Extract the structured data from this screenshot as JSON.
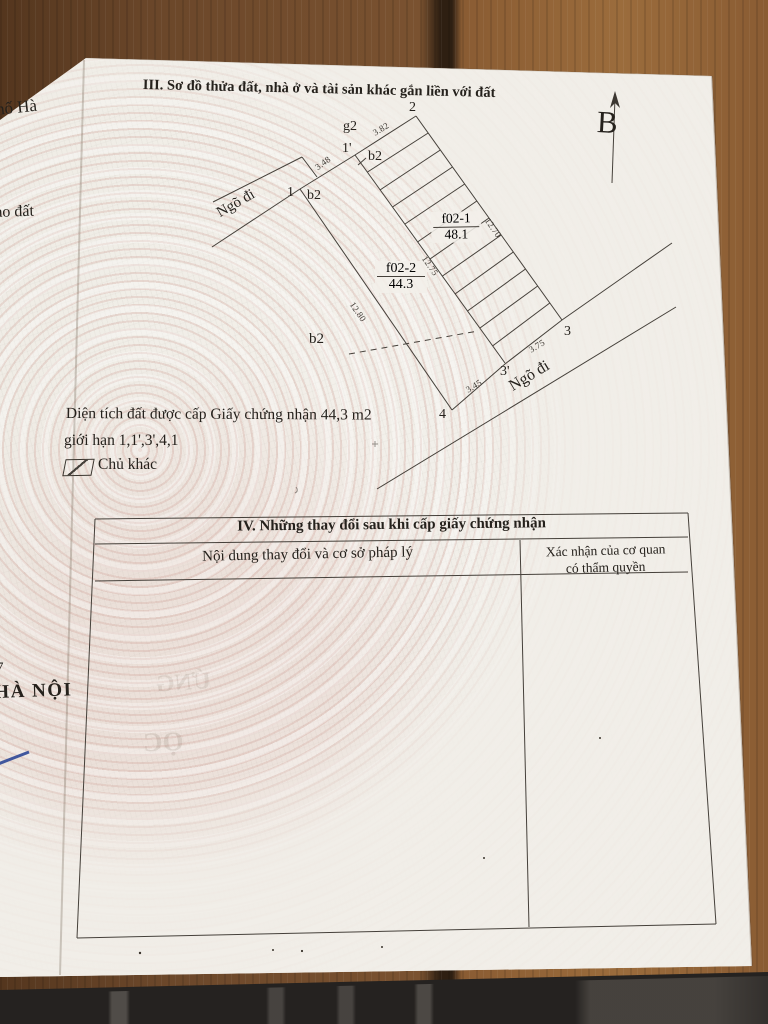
{
  "page": {
    "section3_title": "III. Sơ đồ thửa đất, nhà ở và tài sản khác gắn liền với đất",
    "north_label": "B",
    "notes": {
      "area_line1": "Diện tích đất được cấp Giấy chứng nhận 44,3 m2",
      "area_line2": "giới hạn 1,1',3',4,1"
    },
    "legend": {
      "other_owner": "Chủ khác"
    },
    "section4": {
      "title": "IV. Những thay đổi sau khi cấp giấy chứng nhận",
      "col1": "Nội dung thay đổi và cơ sở pháp lý",
      "col2_line1": "Xác nhận của cơ quan",
      "col2_line2": "có thẩm quyền"
    }
  },
  "diagram": {
    "vertices": {
      "v1": "1",
      "v1p": "1'",
      "v2": "2",
      "v3": "3",
      "v3p": "3'",
      "v4": "4"
    },
    "parcels": {
      "g2": "g2",
      "b2_top": "b2",
      "b2_mid": "b2",
      "b2_low": "b2"
    },
    "plots": {
      "main_id": "f02-2",
      "main_area": "44.3",
      "other_id": "f02-1",
      "other_area": "48.1"
    },
    "dims": {
      "d_1_1p": "3.48",
      "d_1p_2": "3.82",
      "d_1_4": "12.80",
      "d_1p_3p": "12.75",
      "d_2_3": "12.70",
      "d_3_3p": "3.75",
      "d_3p_4": "3.45"
    },
    "roads": {
      "left": "Ngõ đi",
      "bottom": "Ngõ đi"
    }
  },
  "edge_fragments": {
    "top": "hố Hà",
    "middle": "ao đất",
    "num": "7",
    "bottom": "HÀ NỘI"
  },
  "bleed_through": {
    "text1": "ỨNG",
    "text2": "ỌC"
  },
  "colors": {
    "paper": "#f2efe9",
    "wood": "#7a5230",
    "wood_gap": "#2e1f12",
    "ink": "#25211c",
    "line": "#45403a",
    "pattern_pink": "#cb968c",
    "pen_blue": "#2e4796"
  }
}
